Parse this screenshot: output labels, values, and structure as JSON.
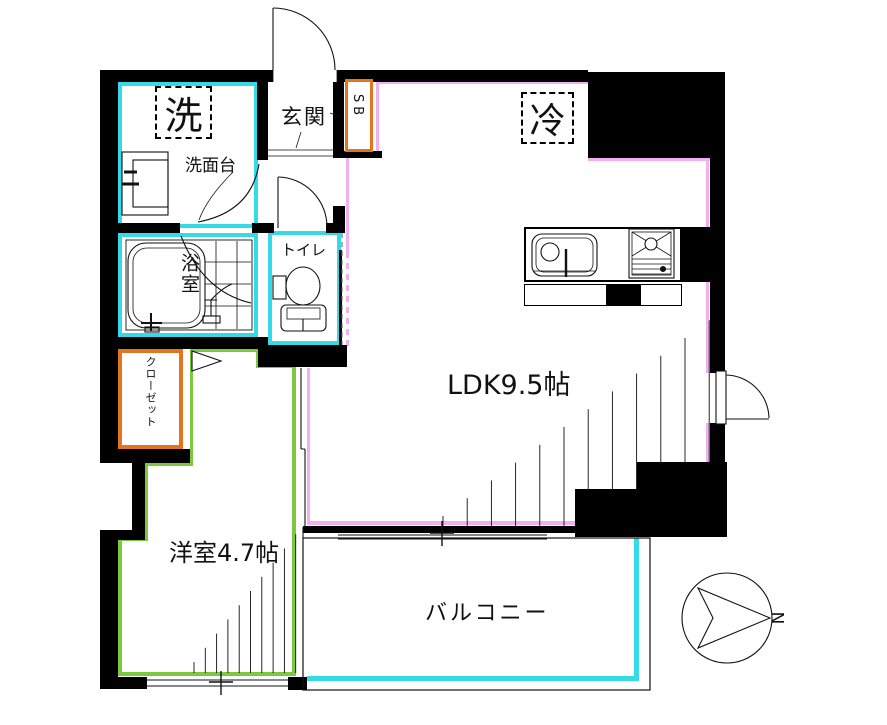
{
  "plan": {
    "labels": {
      "laundry": "洗",
      "entrance": "玄関",
      "shoe_box": "SB",
      "refrigerator": "冷",
      "washstand": "洗面台",
      "bathroom": "浴室",
      "toilet": "トイレ",
      "closet": "クローゼット",
      "ldk": "LDK9.5帖",
      "western_room": "洋室4.7帖",
      "balcony": "バルコニー",
      "compass_north": "N"
    },
    "colors": {
      "wall": "#000000",
      "wet_area_outline": "#35d9e8",
      "western_room_outline": "#7dc83e",
      "ldk_outline": "#f2b0f2",
      "storage_outline": "#e2761e"
    }
  }
}
